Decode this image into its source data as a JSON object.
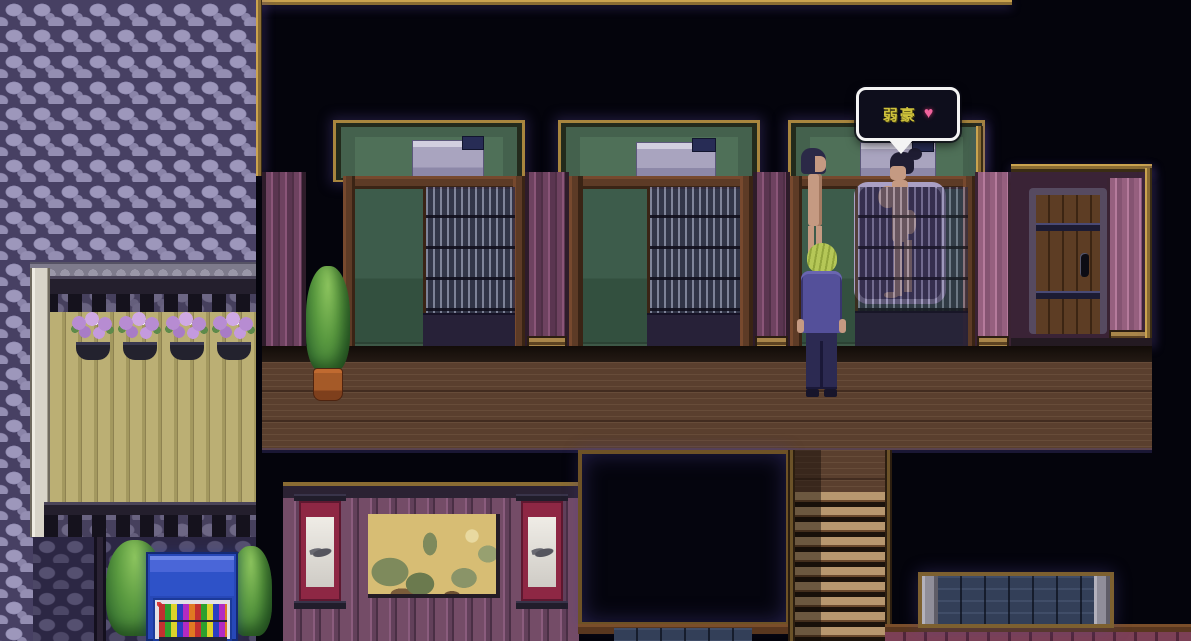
{
  "scene": {
    "name_bubble": {
      "text": "弱豪",
      "heart": "♥",
      "text_color": "#cfc23c",
      "heart_color": "#f2649e",
      "border_color": "#f4f4f4",
      "background": "#0e0e1c"
    },
    "palette": {
      "background_black": "#04040c",
      "cobblestone": "#9d97bb",
      "fence_planks": "#bbaf74",
      "flower_purple": "#b78cd2",
      "trim_gold": "#a8853e",
      "pillar_purple": "#6e4260",
      "stall_green": "#44614d",
      "screen_slate": "#8f8cab",
      "deck_brown": "#5a3f2e",
      "stair_light": "#b7976f",
      "painting_wall": "#744c67",
      "scroll_red": "#8e2744",
      "painting_gold": "#d7bd74",
      "bluestone": "#333f58",
      "vending_blue": "#2e52c8",
      "player_hair_green": "#b5c757",
      "npc_hair_navy": "#2b2947",
      "suit_blue": "#54509a"
    },
    "icons": {
      "heart": "heart-icon",
      "bubble_tail": "pointer-down-icon"
    }
  }
}
